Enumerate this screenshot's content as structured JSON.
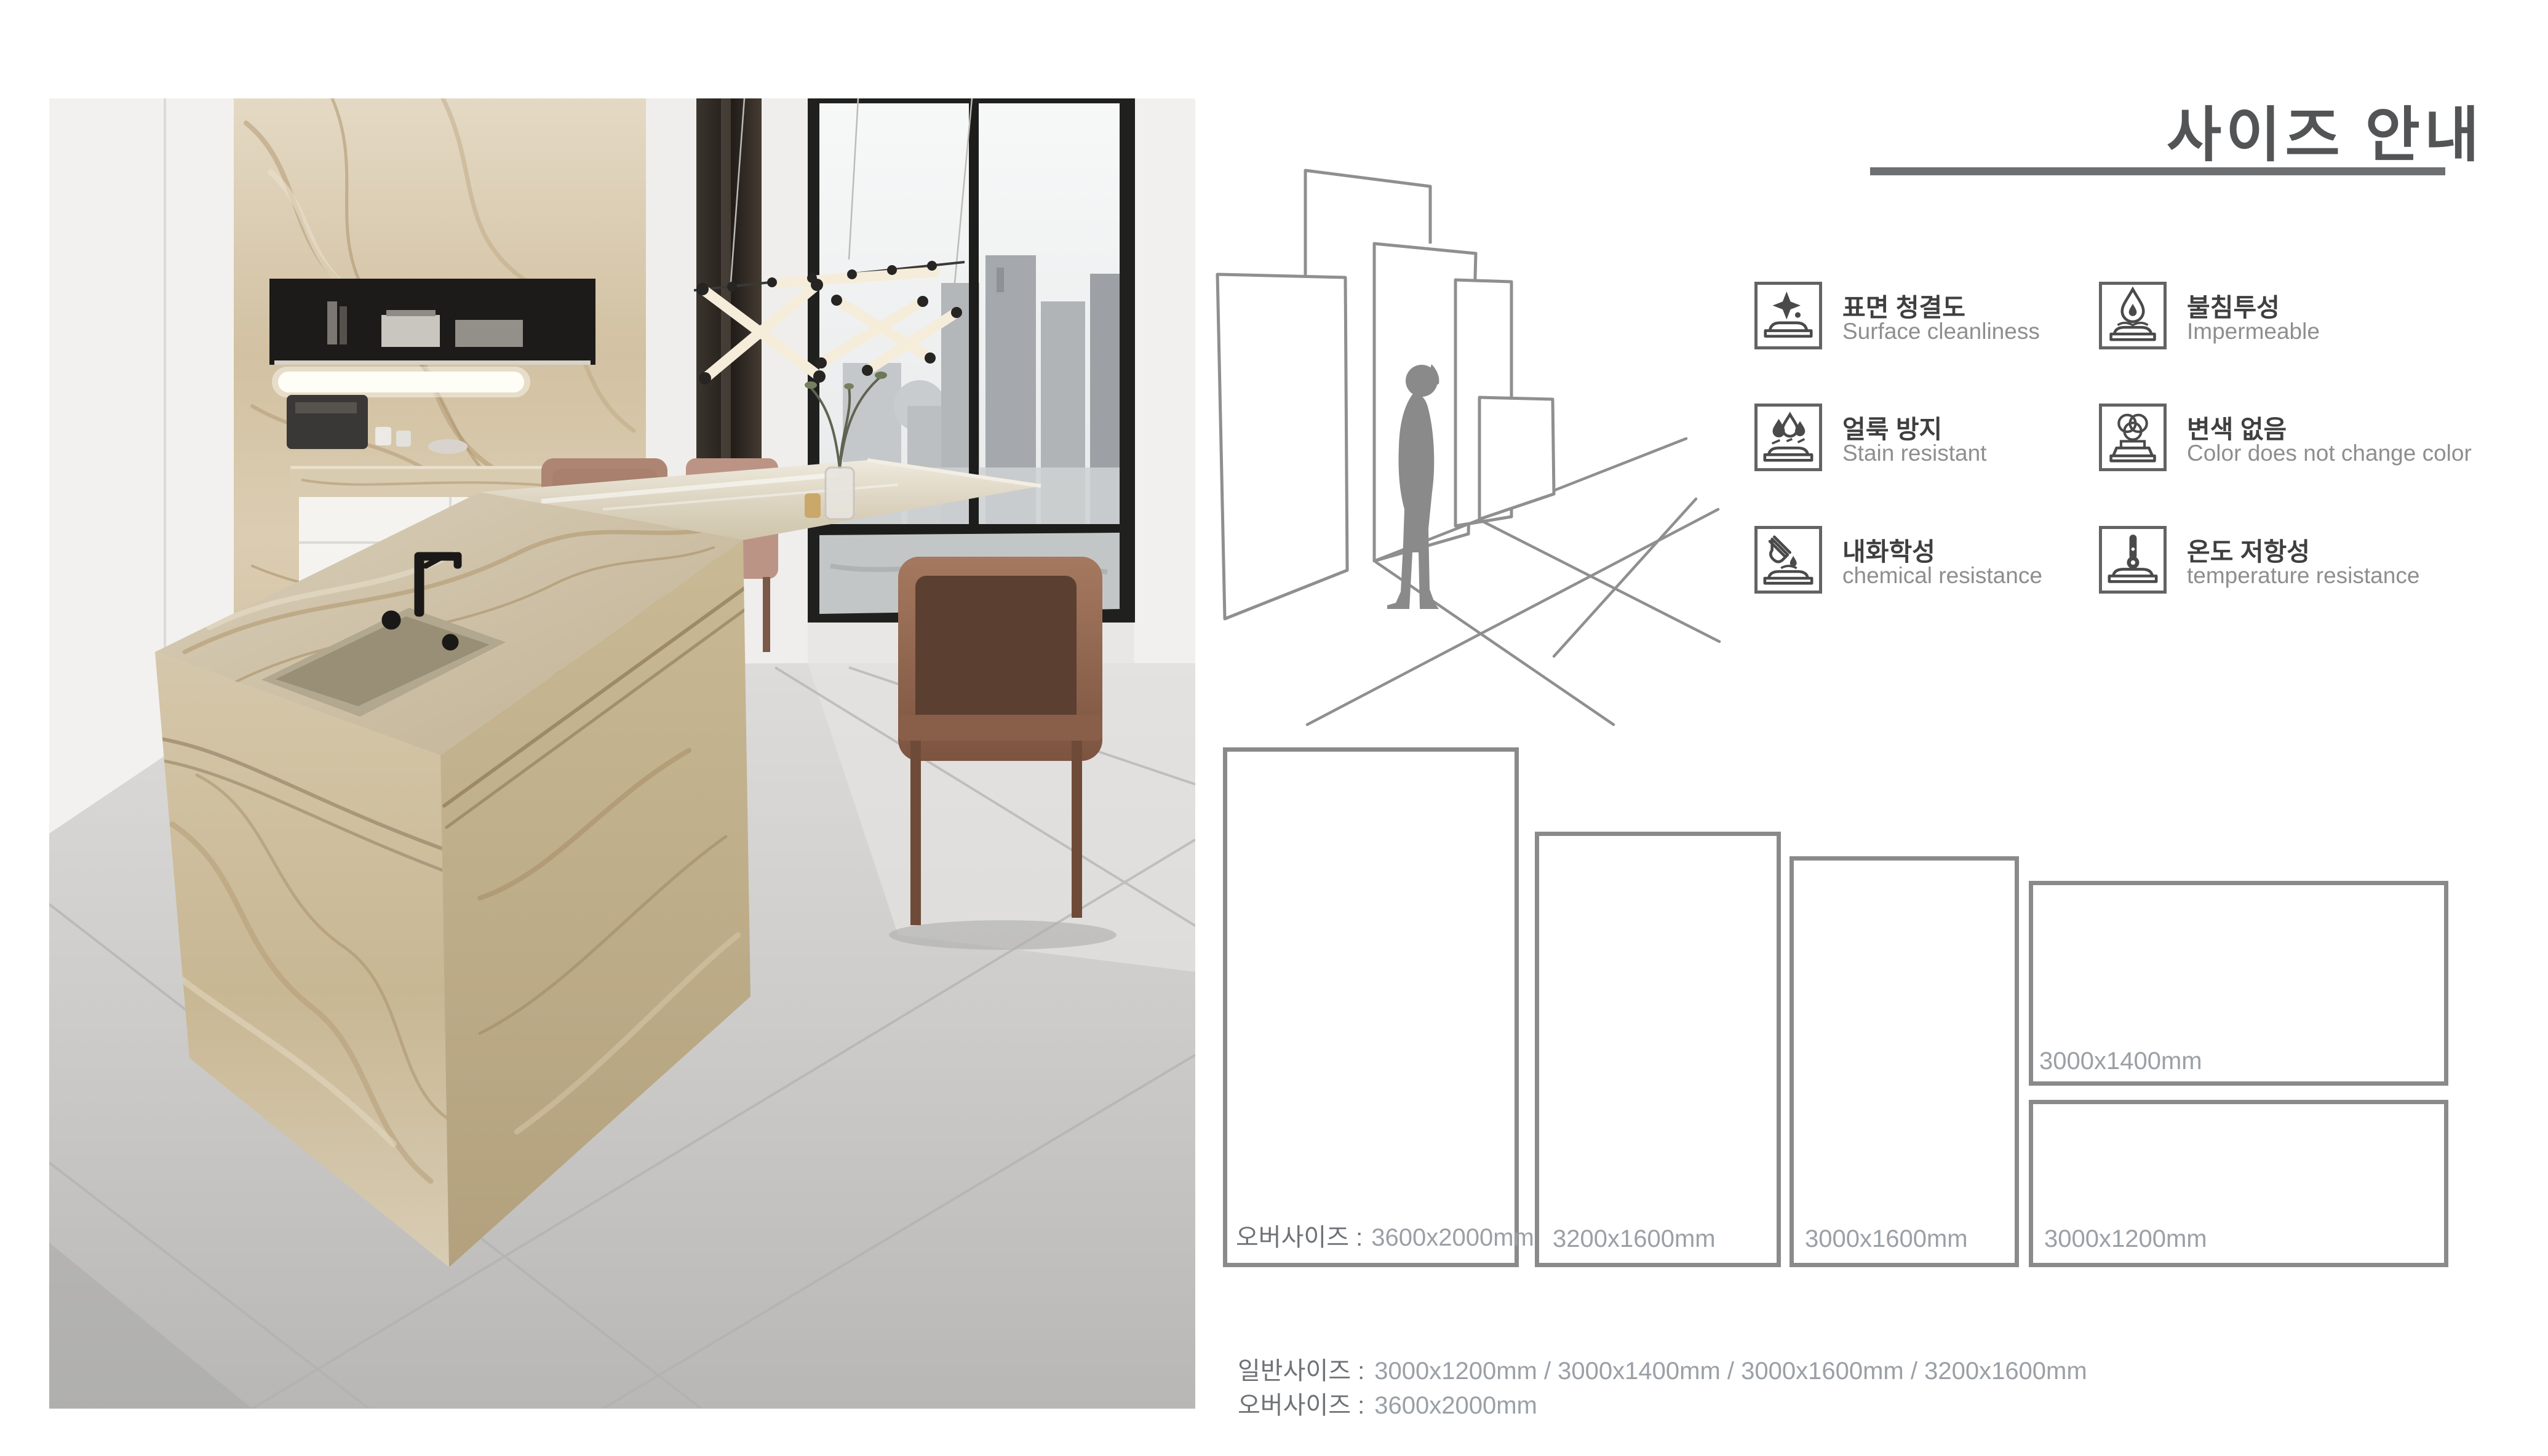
{
  "title": {
    "text": "사이즈 안내",
    "color": "#525456",
    "underline_color": "#6e6f71"
  },
  "features": {
    "korean_color": "#3f3f3f",
    "english_color": "#8e8e8e",
    "items": [
      {
        "icon": "sparkle-clean-icon",
        "ko": "표면 청결도",
        "en": "Surface cleanliness"
      },
      {
        "icon": "water-drop-icon",
        "ko": "불침투성",
        "en": "Impermeable"
      },
      {
        "icon": "stain-drops-icon",
        "ko": "얼룩 방지",
        "en": "Stain resistant"
      },
      {
        "icon": "color-circles-icon",
        "ko": "변색 없음",
        "en": "Color does not change color"
      },
      {
        "icon": "chemical-tube-icon",
        "ko": "내화학성",
        "en": "chemical resistance"
      },
      {
        "icon": "thermometer-icon",
        "ko": "온도 저항성",
        "en": "temperature resistance"
      }
    ]
  },
  "sizes": {
    "border_color": "#8a8a8a",
    "prefix_color": "#6f7276",
    "value_color": "#9aa0a5",
    "panels": [
      {
        "name": "oversize-panel",
        "prefix": "오버사이즈 :",
        "label": "3600x2000mm"
      },
      {
        "name": "panel-3200x1600",
        "prefix": "",
        "label": "3200x1600mm"
      },
      {
        "name": "panel-3000x1600",
        "prefix": "",
        "label": "3000x1600mm"
      },
      {
        "name": "panel-3000x1400",
        "prefix": "",
        "label": "3000x1400mm"
      },
      {
        "name": "panel-3000x1200",
        "prefix": "",
        "label": "3000x1200mm"
      }
    ],
    "summary": [
      {
        "prefix": "일반사이즈 :",
        "value": "3000x1200mm / 3000x1400mm / 3000x1600mm / 3200x1600mm"
      },
      {
        "prefix": "오버사이즈 :",
        "value": "3600x2000mm"
      }
    ]
  },
  "photo": {
    "description": "modern kitchen with beige marble island, black faucet, brown leather dining chairs, black shelf niche, city-view window with hanging tube light"
  },
  "diagram": {
    "description": "person silhouette standing among upright slab panels of different sizes on a perspective floor grid"
  }
}
